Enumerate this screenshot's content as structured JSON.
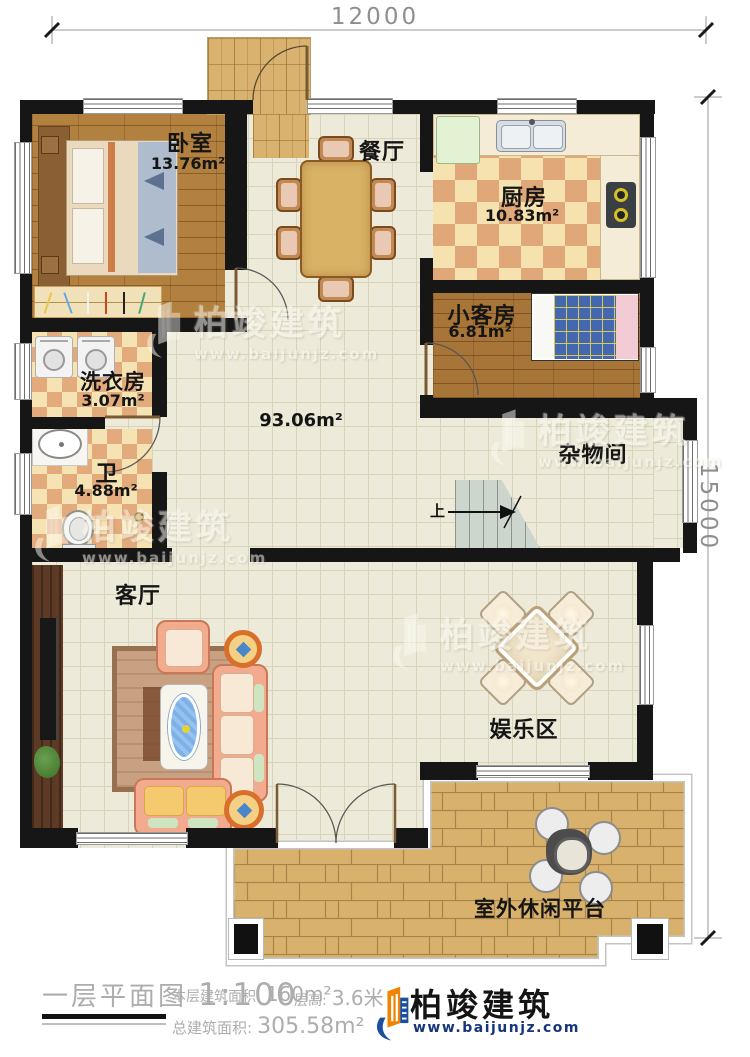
{
  "dimensions": {
    "width_top": "12000",
    "height_right": "15000"
  },
  "rooms": {
    "bedroom": {
      "name": "卧室",
      "area": "13.76m²"
    },
    "dining": {
      "name": "餐厅"
    },
    "kitchen": {
      "name": "厨房",
      "area": "10.83m²"
    },
    "guest_room": {
      "name": "小客房",
      "area": "6.81m²"
    },
    "laundry": {
      "name": "洗衣房",
      "area": "3.07m²"
    },
    "bathroom": {
      "name": "卫",
      "area": "4.88m²"
    },
    "hall": {
      "area": "93.06m²"
    },
    "storage": {
      "name": "杂物间"
    },
    "living_room": {
      "name": "客厅"
    },
    "entertainment": {
      "name": "娱乐区"
    },
    "platform": {
      "name": "室外休闲平台"
    }
  },
  "stairs": {
    "up": "上"
  },
  "footer": {
    "plan_title": "一层平面图",
    "scale": "1:100",
    "floor_area_label": "本层建筑面积:",
    "floor_area_value": "160m²",
    "floor_height_label": "层高:",
    "floor_height_value": "3.6米",
    "total_area_label": "总建筑面积:",
    "total_area_value": "305.58m²"
  },
  "branding": {
    "company": "柏竣建筑",
    "website": "www.baijunjz.com"
  },
  "colors": {
    "wall": "#161616",
    "brand_orange": "#f08300",
    "brand_blue": "#1c4f9c",
    "website_blue": "#16357c"
  }
}
